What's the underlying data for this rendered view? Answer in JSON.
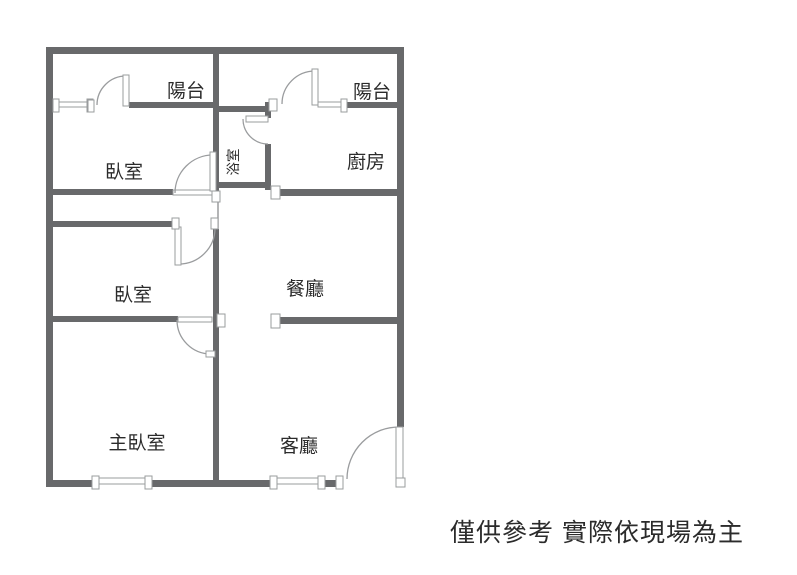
{
  "rooms": {
    "balcony_left": "陽台",
    "bedroom_top": "臥室",
    "bathroom": "浴室",
    "balcony_right": "陽台",
    "kitchen": "廚房",
    "bedroom_middle": "臥室",
    "dining_room": "餐廳",
    "master_bedroom": "主臥室",
    "living_room": "客廳"
  },
  "disclaimer": "僅供參考 實際依現場為主",
  "colors": {
    "wall": "#68696b",
    "line": "#9a9c9e",
    "text": "#2b2b2b",
    "background": "#ffffff"
  }
}
